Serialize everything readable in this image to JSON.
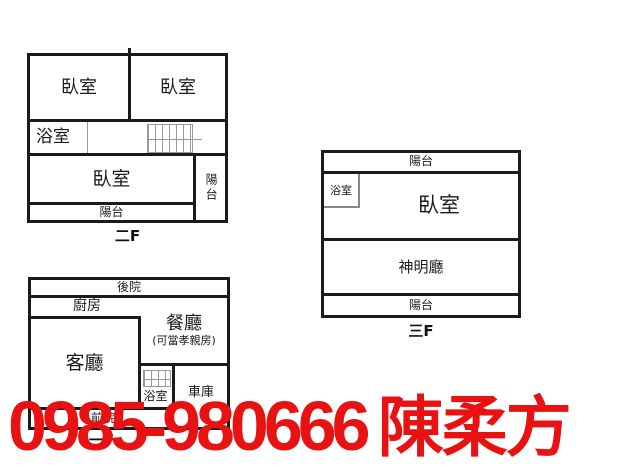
{
  "plans": {
    "floor2": {
      "label": "二F",
      "rooms": {
        "bedroom_top_left": "臥室",
        "bedroom_top_right": "臥室",
        "bathroom": "浴室",
        "bedroom_main": "臥室",
        "balcony_bottom": "陽台",
        "balcony_right": "陽台"
      }
    },
    "floor3": {
      "label": "三F",
      "rooms": {
        "balcony_top": "陽台",
        "bathroom": "浴室",
        "bedroom": "臥室",
        "shrine_hall": "神明廳",
        "balcony_bottom": "陽台"
      }
    },
    "floor1": {
      "label": "一F",
      "rooms": {
        "backyard": "後院",
        "kitchen": "廚房",
        "living_room": "客廳",
        "dining_room": "餐廳",
        "dining_room_note": "(可當孝親房)",
        "bathroom": "浴室",
        "garage": "車庫",
        "front_yard": "前院"
      }
    }
  },
  "overlay": {
    "phone": "0985-980666",
    "name": "陳柔方",
    "color": "#e91212"
  },
  "colors": {
    "wall": "#1b1b1b",
    "stairs_line": "#9a9a9a",
    "background": "#ffffff"
  }
}
